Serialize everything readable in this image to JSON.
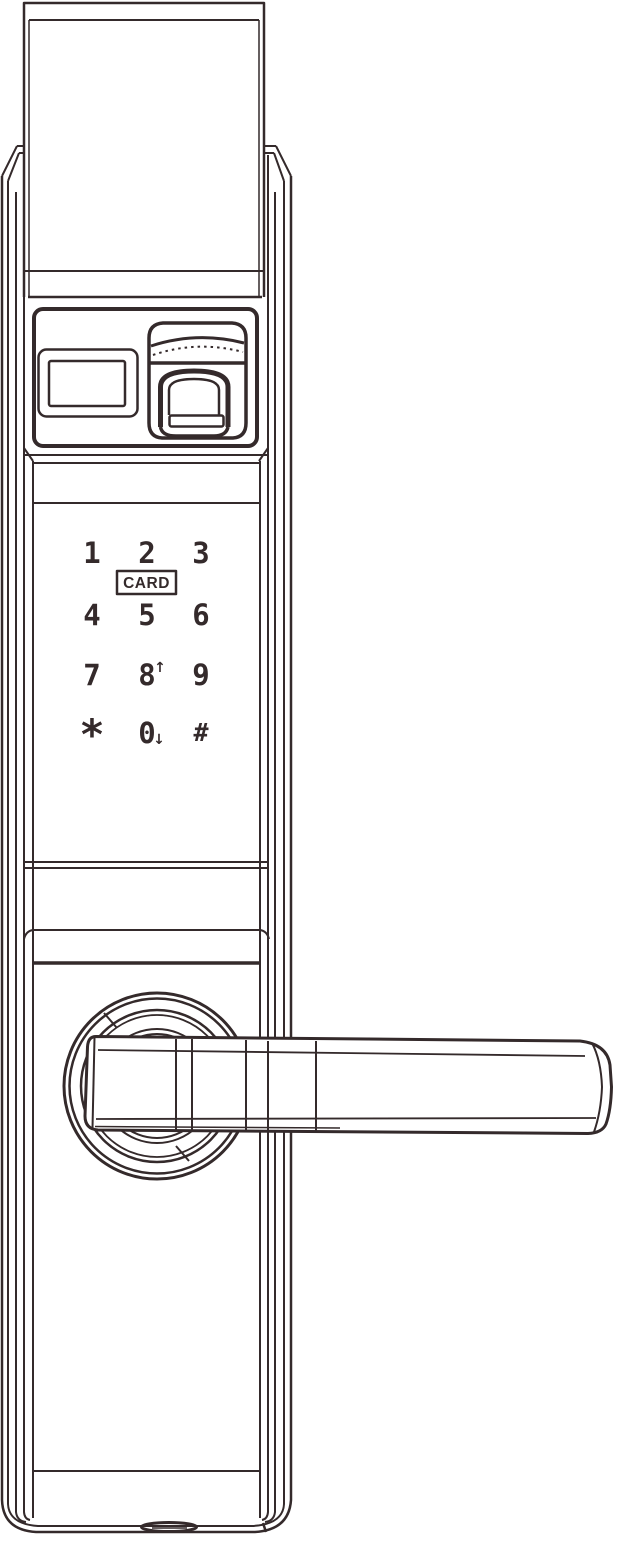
{
  "device": {
    "style": {
      "ink": "#342a2b",
      "background": "#ffffff"
    },
    "parts": [
      "top-cover",
      "display-window",
      "fingerprint-sensor",
      "touch-keypad",
      "card-reader",
      "door-handle-lever",
      "handle-rosette",
      "bottom-port"
    ]
  },
  "keypad": {
    "card_label": "CARD",
    "keys": [
      {
        "label": "1"
      },
      {
        "label": "2"
      },
      {
        "label": "3"
      },
      {
        "label": "4"
      },
      {
        "label": "5"
      },
      {
        "label": "6"
      },
      {
        "label": "7"
      },
      {
        "label": "8",
        "arrow": "↑"
      },
      {
        "label": "9"
      },
      {
        "label": "*"
      },
      {
        "label": "0",
        "arrow": "↓"
      },
      {
        "label": "#"
      }
    ]
  }
}
